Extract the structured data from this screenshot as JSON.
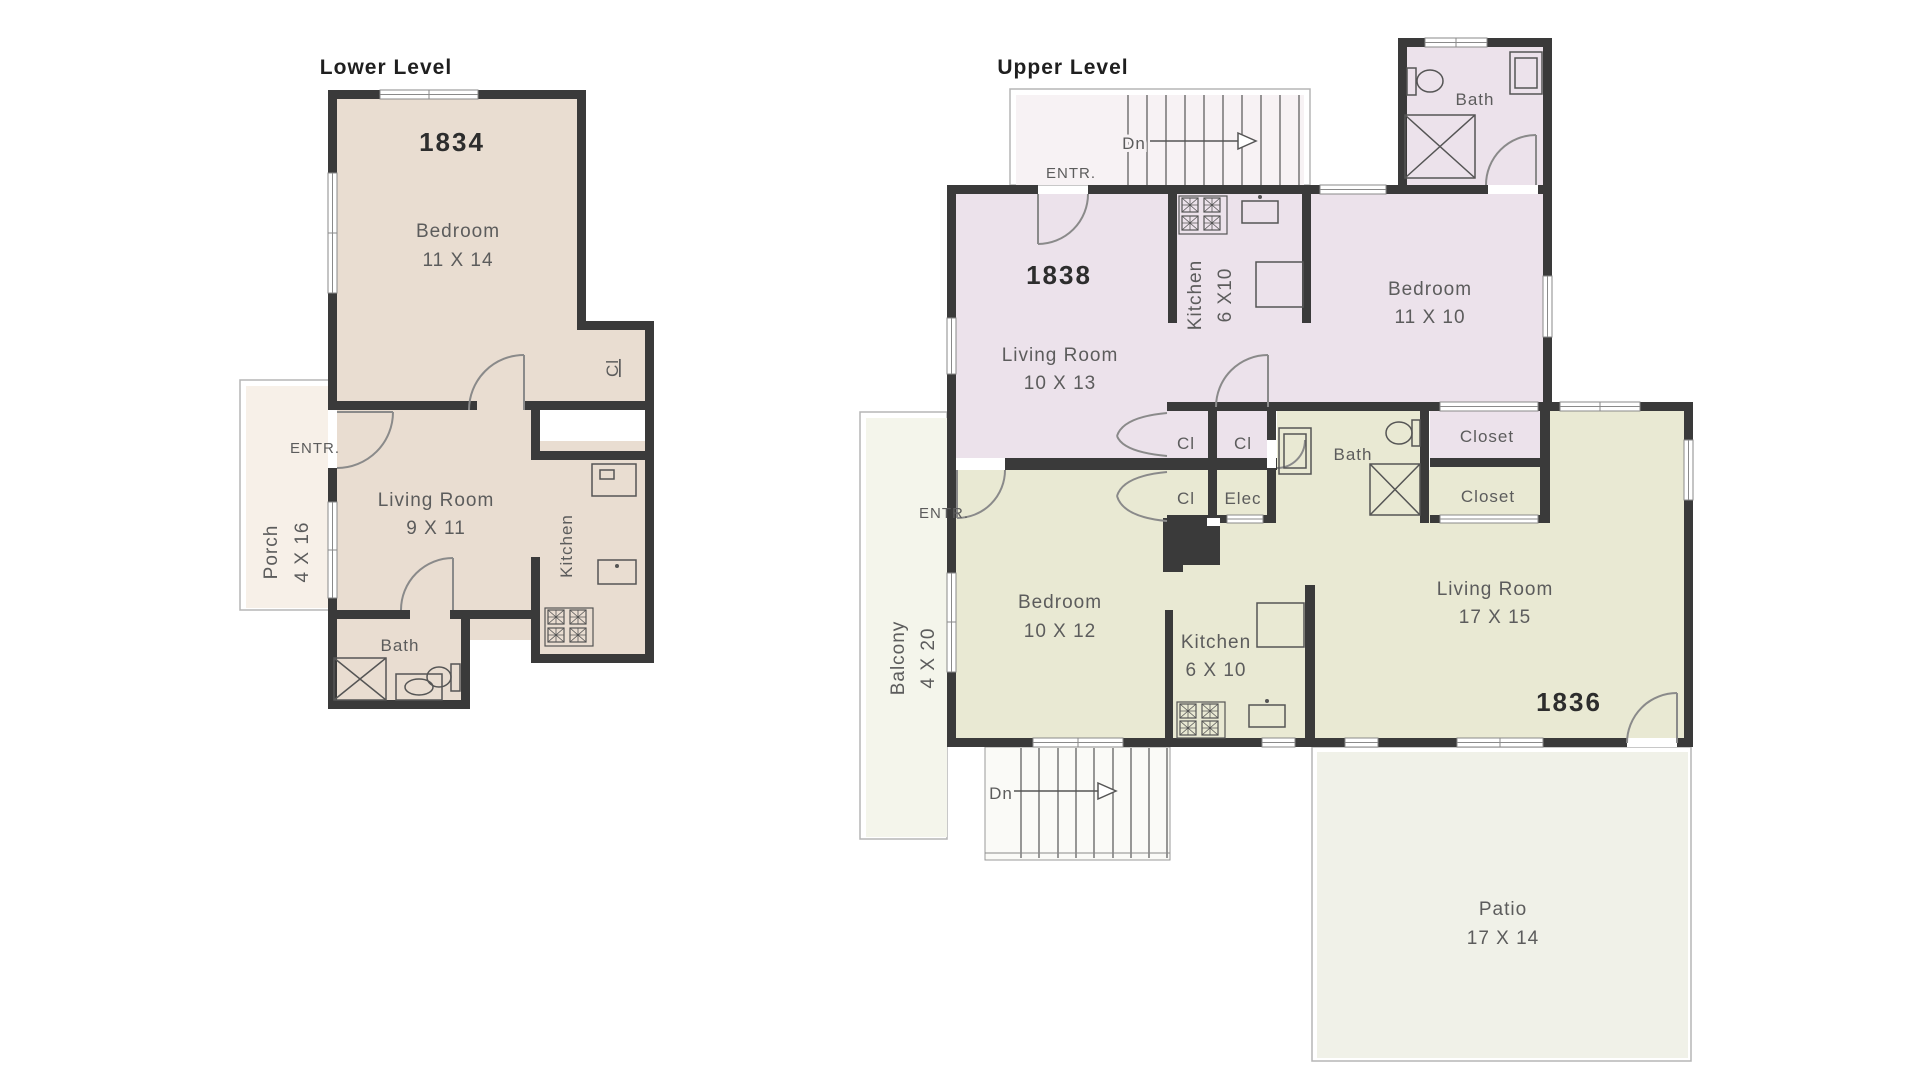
{
  "colors": {
    "wall": "#3a3a3a",
    "unit_1834_floor": "#e9ddd1",
    "porch_floor": "#f7f0e8",
    "unit_1838_floor": "#ece2eb",
    "stair_landing_floor": "#f7f2f4",
    "unit_1836_floor": "#e9e9d3",
    "balcony_floor": "#f4f5eb",
    "patio_floor": "#f0f1e8",
    "stairs_lower_floor": "#fafaf7",
    "line_gray": "#8a8a8a",
    "text_gray": "#5c5c5c",
    "text_dark": "#2d2d2d"
  },
  "lower": {
    "title": "Lower Level",
    "unit_number": "1834",
    "bedroom": {
      "name": "Bedroom",
      "dims": "11 X 14"
    },
    "closet": "Cl",
    "entry": "ENTR.",
    "living_room": {
      "name": "Living Room",
      "dims": "9 X 11"
    },
    "kitchen": {
      "name": "Kitchen"
    },
    "porch": {
      "name": "Porch",
      "dims": "4 X 16"
    },
    "bath": {
      "name": "Bath"
    }
  },
  "upper": {
    "title": "Upper Level",
    "stairs_top": {
      "dn": "Dn",
      "entry": "ENTR."
    },
    "stairs_bottom": {
      "dn": "Dn"
    },
    "unit_1838": {
      "unit_number": "1838",
      "living_room": {
        "name": "Living Room",
        "dims": "10 X 13"
      },
      "kitchen": {
        "name": "Kitchen",
        "dims": "6 X10"
      },
      "bedroom": {
        "name": "Bedroom",
        "dims": "11 X 10"
      },
      "bath": {
        "name": "Bath"
      },
      "closet_a": "Cl",
      "closet_b": "Cl"
    },
    "unit_1836": {
      "unit_number": "1836",
      "entry": "ENTR.",
      "bedroom": {
        "name": "Bedroom",
        "dims": "10 X 12"
      },
      "kitchen": {
        "name": "Kitchen",
        "dims": "6 X 10"
      },
      "living_room": {
        "name": "Living Room",
        "dims": "17 X 15"
      },
      "bath": {
        "name": "Bath"
      },
      "closet_small": "Cl",
      "elec": "Elec",
      "closet_upper": "Closet",
      "closet_lower": "Closet",
      "balcony": {
        "name": "Balcony",
        "dims": "4 X 20"
      },
      "patio": {
        "name": "Patio",
        "dims": "17 X 14"
      }
    }
  }
}
